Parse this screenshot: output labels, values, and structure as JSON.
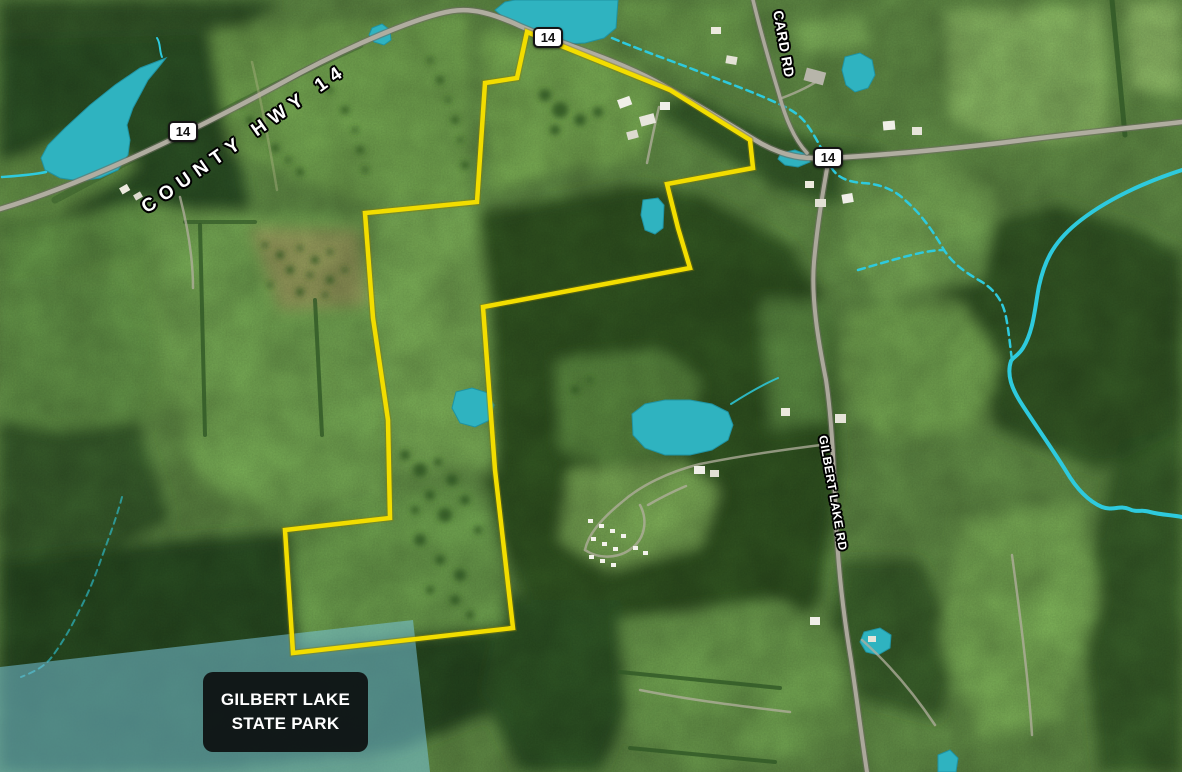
{
  "map": {
    "road_labels": {
      "county_hwy": "COUNTY HWY 14",
      "card_rd": "CARD RD",
      "gilbert_lake_rd": "GILBERT LAKE RD"
    },
    "shields": {
      "left": "14",
      "top": "14",
      "right": "14"
    },
    "park_label": {
      "line1": "GILBERT LAKE",
      "line2": "STATE PARK"
    },
    "colors": {
      "boundary": "#f2dd00",
      "water": "#2fb3c0",
      "stream": "#2ecadd",
      "park_overlay": "#79c7de",
      "shield_bg": "#ffffff",
      "shield_border": "#151515",
      "label_text": "#ffffff",
      "park_box_bg": "#0a0a0a"
    }
  }
}
